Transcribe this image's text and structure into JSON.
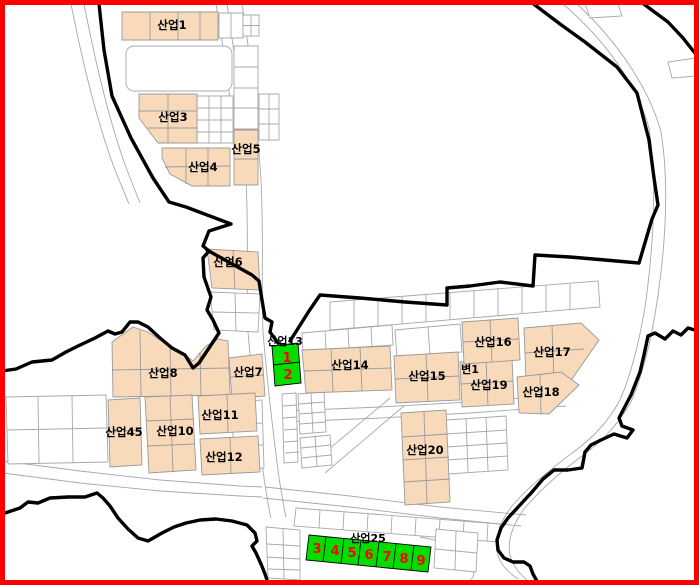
{
  "colors": {
    "frame": "#ff0000",
    "boundary": "#000000",
    "parcel-line": "#a8a8a8",
    "block-line": "#9a9a9a",
    "block-fill": "#f8daba",
    "highlight-fill": "#00dd00",
    "highlight-number": "#ff0000",
    "label": "#000000",
    "background": "#ffffff"
  },
  "blocks": [
    {
      "id": "saneop-1",
      "label": "산업1"
    },
    {
      "id": "saneop-3",
      "label": "산업3"
    },
    {
      "id": "saneop-4",
      "label": "산업4"
    },
    {
      "id": "saneop-5",
      "label": "산업5"
    },
    {
      "id": "saneop-6",
      "label": "산업6"
    },
    {
      "id": "saneop-7",
      "label": "산업7"
    },
    {
      "id": "saneop-8",
      "label": "산업8"
    },
    {
      "id": "saneop-45",
      "label": "산업45"
    },
    {
      "id": "saneop-10",
      "label": "산업10"
    },
    {
      "id": "saneop-11",
      "label": "산업11"
    },
    {
      "id": "saneop-12",
      "label": "산업12"
    },
    {
      "id": "saneop-14",
      "label": "산업14"
    },
    {
      "id": "saneop-15",
      "label": "산업15"
    },
    {
      "id": "saneop-16",
      "label": "산업16"
    },
    {
      "id": "saneop-17",
      "label": "산업17"
    },
    {
      "id": "saneop-18",
      "label": "산업18"
    },
    {
      "id": "saneop-19",
      "label": "산업19"
    },
    {
      "id": "byeon-1",
      "label": "변1"
    },
    {
      "id": "saneop-20",
      "label": "산업20"
    }
  ],
  "highlights": [
    {
      "id": "saneop-13",
      "label": "산업13",
      "cells": [
        "1",
        "2"
      ]
    },
    {
      "id": "saneop-25",
      "label": "산업25",
      "cells": [
        "3",
        "4",
        "5",
        "6",
        "7",
        "8",
        "9"
      ]
    }
  ]
}
